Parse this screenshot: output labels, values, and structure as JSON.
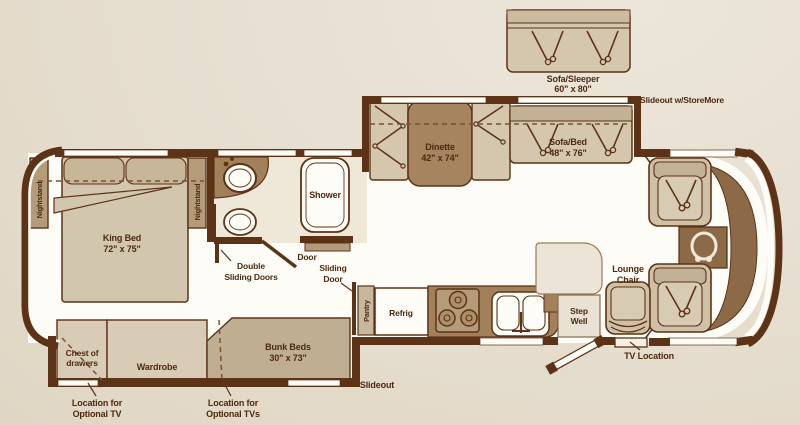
{
  "plan": {
    "kind": "RV floor plan diagram",
    "colors": {
      "background": "#e7dfd1",
      "wall": "#5c3317",
      "floor": "#fdfcf7",
      "bath_floor": "#efe7d8",
      "furniture_light": "#d5c7ae",
      "furniture_mid": "#c2b195",
      "furniture_dark": "#a1805a",
      "cabinet_tan": "#b49b79",
      "dashboard": "#8d6a47",
      "text": "#4d2a10"
    }
  },
  "labels": {
    "sofa_sleeper": {
      "line1": "Sofa/Sleeper",
      "line2": "60\" x 80\""
    },
    "slideout_storemore": "Slideout w/StoreMore",
    "dinette": {
      "line1": "Dinette",
      "line2": "42\" x 74\""
    },
    "sofa_bed": {
      "line1": "Sofa/Bed",
      "line2": "48\" x 76\""
    },
    "king_bed": {
      "line1": "King Bed",
      "line2": "72\" x 75\""
    },
    "nightstand_left": "Nightstand",
    "nightstand_right": "Nightstand",
    "shower": "Shower",
    "door": "Door",
    "double_sliding_doors": {
      "line1": "Double",
      "line2": "Sliding Doors"
    },
    "sliding_door": {
      "line1": "Sliding",
      "line2": "Door"
    },
    "pantry": "Pantry",
    "refrig": "Refrig",
    "step_well": {
      "line1": "Step",
      "line2": "Well"
    },
    "lounge_chair": {
      "line1": "Lounge",
      "line2": "Chair"
    },
    "tv_location": "TV Location",
    "chest_of_drawers": {
      "line1": "Chest of",
      "line2": "drawers"
    },
    "wardrobe": "Wardrobe",
    "bunk_beds": {
      "line1": "Bunk Beds",
      "line2": "30\" x 73\""
    },
    "optional_tv": {
      "line1": "Location for",
      "line2": "Optional TV"
    },
    "optional_tvs": {
      "line1": "Location for",
      "line2": "Optional TVs"
    },
    "slideout_rear": "Slideout"
  }
}
